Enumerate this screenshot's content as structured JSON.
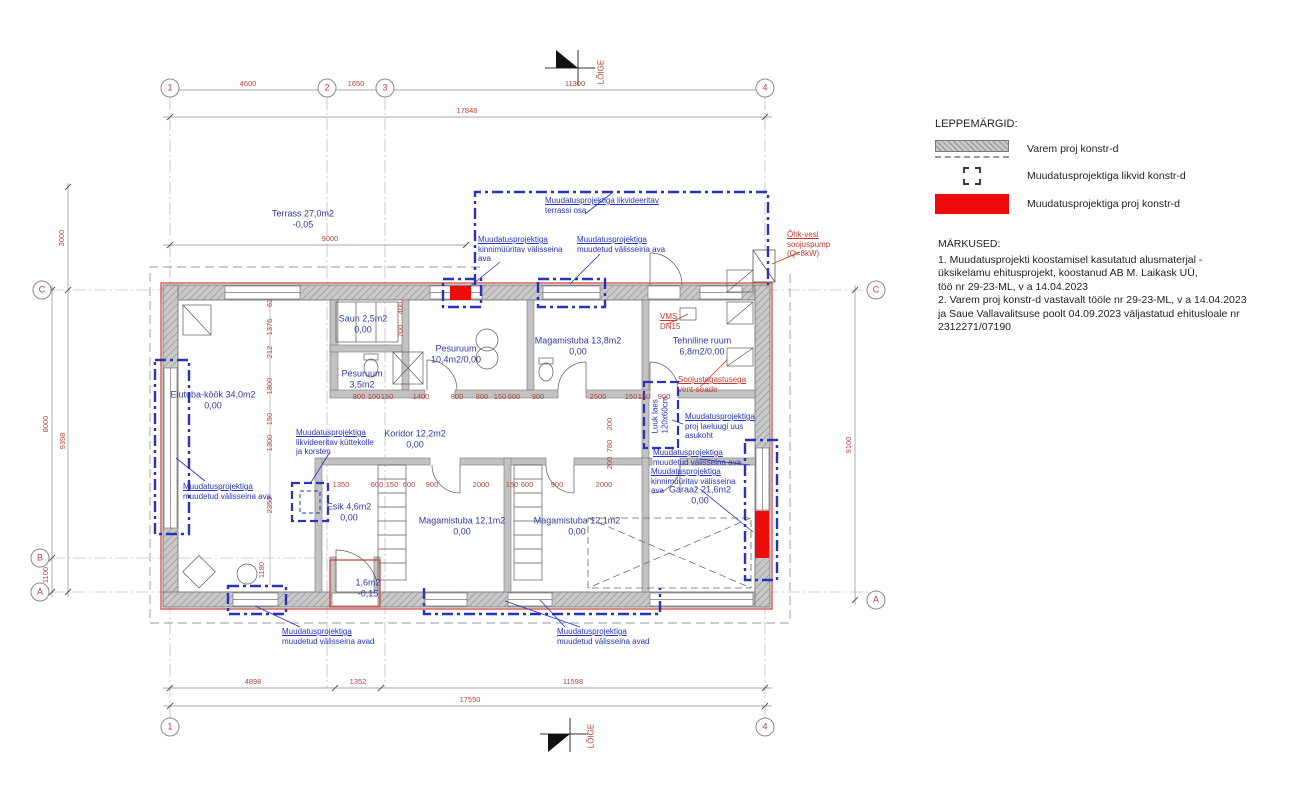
{
  "legend": {
    "title": "LEPPEMÄRGID:",
    "items": [
      {
        "symbol": "hatched-wall-symbol",
        "label": "Varem proj konstr-d"
      },
      {
        "symbol": "dashed-outline-symbol",
        "label": "Muudatusprojektiga likvid konstr-d"
      },
      {
        "symbol": "red-fill-symbol",
        "label": "Muudatusprojektiga proj konstr-d"
      }
    ]
  },
  "notes": {
    "title": "MÄRKUSED:",
    "lines": [
      "1. Muudatusprojekti koostamisel kasutatud alusmaterjal -",
      "üksikelamu ehitusprojekt, koostanud AB M. Laikask UÜ,",
      "töö nr 29-23-ML, v a 14.04.2023",
      "2. Varem proj konstr-d vastavalt tööle nr 29-23-ML, v a 14.04.2023",
      "ja Saue Vallavalitsuse poolt 04.09.2023 väljastatud ehitusloale nr",
      "2312271/07190"
    ]
  },
  "colors": {
    "new_construction": "#ee0b0b",
    "change_blue": "#2733bb",
    "dimension_red": "#b4433a",
    "wall_gray": "#c7c7c7"
  },
  "grid_bubbles": [
    {
      "t": "1",
      "x": 170,
      "y": 88
    },
    {
      "t": "2",
      "x": 327,
      "y": 88
    },
    {
      "t": "3",
      "x": 385,
      "y": 88
    },
    {
      "t": "4",
      "x": 765,
      "y": 88
    },
    {
      "t": "1",
      "x": 170,
      "y": 727
    },
    {
      "t": "4",
      "x": 765,
      "y": 727
    },
    {
      "t": "C",
      "x": 42,
      "y": 290
    },
    {
      "t": "B",
      "x": 40,
      "y": 558
    },
    {
      "t": "A",
      "x": 40,
      "y": 592
    },
    {
      "t": "C",
      "x": 876,
      "y": 290
    },
    {
      "t": "A",
      "x": 876,
      "y": 600
    }
  ],
  "plan": {
    "texts": [
      {
        "t": "Terrass 27,0m2\n-0,05",
        "x": 303,
        "y": 219,
        "c": "room"
      },
      {
        "t": "Elutuba-köök 34,0m2\n0,00",
        "x": 213,
        "y": 400,
        "c": "room"
      },
      {
        "t": "Saun 2,5m2\n0,00",
        "x": 363,
        "y": 324,
        "c": "room"
      },
      {
        "t": "Pesuruum\n3,5m2",
        "x": 362,
        "y": 379,
        "c": "room"
      },
      {
        "t": "Pesuruum\n10,4m2/0,00",
        "x": 456,
        "y": 354,
        "c": "room"
      },
      {
        "t": "Magamistuba 13,8m2\n0,00",
        "x": 578,
        "y": 346,
        "c": "room"
      },
      {
        "t": "Tehniline ruum\n6,8m2/0,00",
        "x": 702,
        "y": 346,
        "c": "room"
      },
      {
        "t": "Koridor 12,2m2\n0,00",
        "x": 415,
        "y": 439,
        "c": "room"
      },
      {
        "t": "Esik 4,6m2\n0,00",
        "x": 349,
        "y": 512,
        "c": "room"
      },
      {
        "t": "Magamistuba 12,1m2\n0,00",
        "x": 462,
        "y": 526,
        "c": "room"
      },
      {
        "t": "Magamistuba 12,1m2\n0,00",
        "x": 577,
        "y": 526,
        "c": "room"
      },
      {
        "t": "Garaaž 21,6m2\n0,00",
        "x": 700,
        "y": 495,
        "c": "room"
      },
      {
        "t": "1,6m2\n-0,15",
        "x": 368,
        "y": 588,
        "c": "room"
      },
      {
        "t": "4600",
        "x": 248,
        "y": 84,
        "c": "dim"
      },
      {
        "t": "1650",
        "x": 356,
        "y": 84,
        "c": "dim"
      },
      {
        "t": "11300",
        "x": 575,
        "y": 84,
        "c": "dim"
      },
      {
        "t": "17848",
        "x": 467,
        "y": 111,
        "c": "dim"
      },
      {
        "t": "9000",
        "x": 330,
        "y": 239,
        "c": "dim"
      },
      {
        "t": "4898",
        "x": 253,
        "y": 682,
        "c": "dim"
      },
      {
        "t": "1352",
        "x": 358,
        "y": 682,
        "c": "dim"
      },
      {
        "t": "11598",
        "x": 573,
        "y": 682,
        "c": "dim"
      },
      {
        "t": "17550",
        "x": 470,
        "y": 700,
        "c": "dim"
      },
      {
        "t": "800",
        "x": 359,
        "y": 397,
        "c": "dim"
      },
      {
        "t": "100",
        "x": 374,
        "y": 397,
        "c": "dim"
      },
      {
        "t": "150",
        "x": 387,
        "y": 397,
        "c": "dim"
      },
      {
        "t": "1400",
        "x": 421,
        "y": 397,
        "c": "dim"
      },
      {
        "t": "800",
        "x": 457,
        "y": 397,
        "c": "dim"
      },
      {
        "t": "800",
        "x": 482,
        "y": 397,
        "c": "dim"
      },
      {
        "t": "150",
        "x": 500,
        "y": 397,
        "c": "dim"
      },
      {
        "t": "600",
        "x": 514,
        "y": 397,
        "c": "dim"
      },
      {
        "t": "900",
        "x": 538,
        "y": 397,
        "c": "dim"
      },
      {
        "t": "2500",
        "x": 598,
        "y": 397,
        "c": "dim"
      },
      {
        "t": "150",
        "x": 631,
        "y": 397,
        "c": "dim"
      },
      {
        "t": "150",
        "x": 644,
        "y": 397,
        "c": "dim"
      },
      {
        "t": "900",
        "x": 664,
        "y": 397,
        "c": "dim"
      },
      {
        "t": "1350",
        "x": 341,
        "y": 485,
        "c": "dim"
      },
      {
        "t": "600",
        "x": 377,
        "y": 485,
        "c": "dim"
      },
      {
        "t": "150",
        "x": 392,
        "y": 485,
        "c": "dim"
      },
      {
        "t": "600",
        "x": 409,
        "y": 485,
        "c": "dim"
      },
      {
        "t": "900",
        "x": 432,
        "y": 485,
        "c": "dim"
      },
      {
        "t": "2000",
        "x": 481,
        "y": 485,
        "c": "dim"
      },
      {
        "t": "150",
        "x": 512,
        "y": 485,
        "c": "dim"
      },
      {
        "t": "600",
        "x": 527,
        "y": 485,
        "c": "dim"
      },
      {
        "t": "900",
        "x": 557,
        "y": 485,
        "c": "dim"
      },
      {
        "t": "2000",
        "x": 604,
        "y": 485,
        "c": "dim"
      },
      {
        "t": "3000",
        "x": 62,
        "y": 238,
        "c": "dim",
        "r": 1
      },
      {
        "t": "8000",
        "x": 46,
        "y": 424,
        "c": "dim",
        "r": 1
      },
      {
        "t": "9398",
        "x": 63,
        "y": 441,
        "c": "dim",
        "r": 1
      },
      {
        "t": "1100",
        "x": 46,
        "y": 575,
        "c": "dim",
        "r": 1
      },
      {
        "t": "9100",
        "x": 849,
        "y": 445,
        "c": "dim",
        "r": 1
      },
      {
        "t": "62",
        "x": 270,
        "y": 303,
        "c": "dim",
        "r": 1
      },
      {
        "t": "1376",
        "x": 270,
        "y": 327,
        "c": "dim",
        "r": 1
      },
      {
        "t": "212",
        "x": 270,
        "y": 352,
        "c": "dim",
        "r": 1
      },
      {
        "t": "1800",
        "x": 270,
        "y": 386,
        "c": "dim",
        "r": 1
      },
      {
        "t": "150",
        "x": 270,
        "y": 419,
        "c": "dim",
        "r": 1
      },
      {
        "t": "1300",
        "x": 270,
        "y": 443,
        "c": "dim",
        "r": 1
      },
      {
        "t": "2350",
        "x": 270,
        "y": 505,
        "c": "dim",
        "r": 1
      },
      {
        "t": "1180",
        "x": 262,
        "y": 570,
        "c": "dim",
        "r": 1
      },
      {
        "t": "400",
        "x": 401,
        "y": 308,
        "c": "dim",
        "r": 1
      },
      {
        "t": "700",
        "x": 401,
        "y": 331,
        "c": "dim",
        "r": 1
      },
      {
        "t": "200",
        "x": 610,
        "y": 424,
        "c": "dim",
        "r": 1
      },
      {
        "t": "780",
        "x": 610,
        "y": 446,
        "c": "dim",
        "r": 1
      },
      {
        "t": "200",
        "x": 610,
        "y": 463,
        "c": "dim",
        "r": 1
      },
      {
        "t": "Muudatusprojektiga likvideeritav\nterrassi osa",
        "x": 545,
        "y": 196,
        "c": "annb",
        "a": "l",
        "u": 1
      },
      {
        "t": "Muudatusprojektiga\nkinnimüüritav välisseina\nava",
        "x": 478,
        "y": 235,
        "c": "annb",
        "a": "l",
        "u": 1
      },
      {
        "t": "Muudatusprojektiga\nmuudetud välisseina ava",
        "x": 577,
        "y": 235,
        "c": "annb",
        "a": "l",
        "u": 1
      },
      {
        "t": "Muudatusprojektiga\nlikvideeritav küttekolle\nja korsten",
        "x": 296,
        "y": 428,
        "c": "annb",
        "a": "l",
        "u": 1
      },
      {
        "t": "Luuk laes\n120x60cm",
        "x": 660,
        "y": 415,
        "c": "annb",
        "r": 1
      },
      {
        "t": "Muudatusprojektiga\nproj laeluugi uus\nasukoht",
        "x": 685,
        "y": 412,
        "c": "annb",
        "a": "l",
        "u": 1
      },
      {
        "t": "Muudatusprojektiga\nmuudetud välisseina ava",
        "x": 653,
        "y": 448,
        "c": "annb",
        "a": "l",
        "u": 1
      },
      {
        "t": "Muudatusprojektiga\nkinnimüüritav välisseina\nava",
        "x": 651,
        "y": 467,
        "c": "annb",
        "a": "l",
        "u": 1
      },
      {
        "t": "Muudatusprojektiga\nmuudetud välisseina ava",
        "x": 183,
        "y": 482,
        "c": "annb",
        "a": "l",
        "u": 1
      },
      {
        "t": "Muudatusprojektiga\nmuudetud välisseina avad",
        "x": 282,
        "y": 627,
        "c": "annb",
        "a": "l",
        "u": 1
      },
      {
        "t": "Muudatusprojektiga\nmuudetud välisseina avad",
        "x": 557,
        "y": 627,
        "c": "annb",
        "a": "l",
        "u": 1
      },
      {
        "t": "Õhk-vesi\nsoojuspump\n(Q=8kW)",
        "x": 787,
        "y": 230,
        "c": "annr",
        "a": "l",
        "u": 1
      },
      {
        "t": "VMS\nDN15",
        "x": 660,
        "y": 312,
        "c": "annr",
        "a": "l",
        "u": 1
      },
      {
        "t": "Soojustagastusega\nvent-seade",
        "x": 678,
        "y": 375,
        "c": "annr",
        "a": "l",
        "u": 1
      },
      {
        "t": "LÕIGE",
        "x": 601,
        "y": 72,
        "c": "annr",
        "r": 1
      },
      {
        "t": "LÕIGE",
        "x": 591,
        "y": 736,
        "c": "annr",
        "r": 1
      }
    ]
  }
}
